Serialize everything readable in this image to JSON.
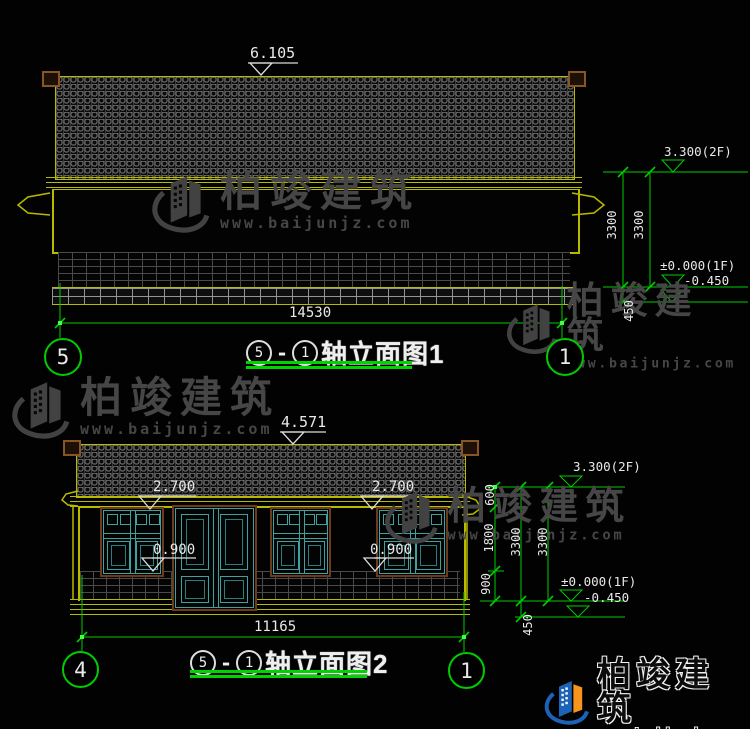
{
  "colors": {
    "cad_yellow": "#b9b900",
    "dim_green": "#00cc00",
    "bright_green": "#00d400",
    "text_white": "#e9e9e9",
    "window_teal": "#3fa0a0",
    "frame_brown": "#6e3a1e",
    "roof_cap_brown": "#8a5526",
    "watermark_gray": "#464646",
    "logo_blue": "#1c63b7",
    "logo_orange": "#f7941e"
  },
  "drawing1": {
    "elev_top": "6.105",
    "width_dim": "14530",
    "bubble_left": "5",
    "bubble_right": "1",
    "title": {
      "axis_start": "5",
      "dash": "-",
      "axis_end": "1",
      "name": "轴立面图1"
    },
    "levels": {
      "l2f": "3.300(2F)",
      "l1f": "±0.000(1F)",
      "lbase": "-0.450"
    },
    "vdims": {
      "a": "3300",
      "b": "3300",
      "c": "450"
    }
  },
  "drawing2": {
    "elev_top": "4.571",
    "width_dim": "11165",
    "bubble_left": "4",
    "bubble_right": "1",
    "title": {
      "axis_start": "5",
      "dash": "-",
      "axis_end": "1",
      "name": "轴立面图2"
    },
    "levels": {
      "l2f": "3.300(2F)",
      "l1f": "±0.000(1F)",
      "lbase": "-0.450"
    },
    "vdims": {
      "v600": "600",
      "v1800": "1800",
      "v900": "900",
      "v3300a": "3300",
      "v3300b": "3300",
      "v450": "450"
    },
    "win_dims": {
      "top_left": "2.700",
      "top_right": "2.700",
      "sill_left": "0.900",
      "sill_right": "0.900"
    }
  },
  "watermark": {
    "cn": "柏竣建筑",
    "url": "www.baijunjz.com"
  },
  "logo": {
    "cn": "柏竣建筑",
    "url": "www.baijunjz.com"
  }
}
